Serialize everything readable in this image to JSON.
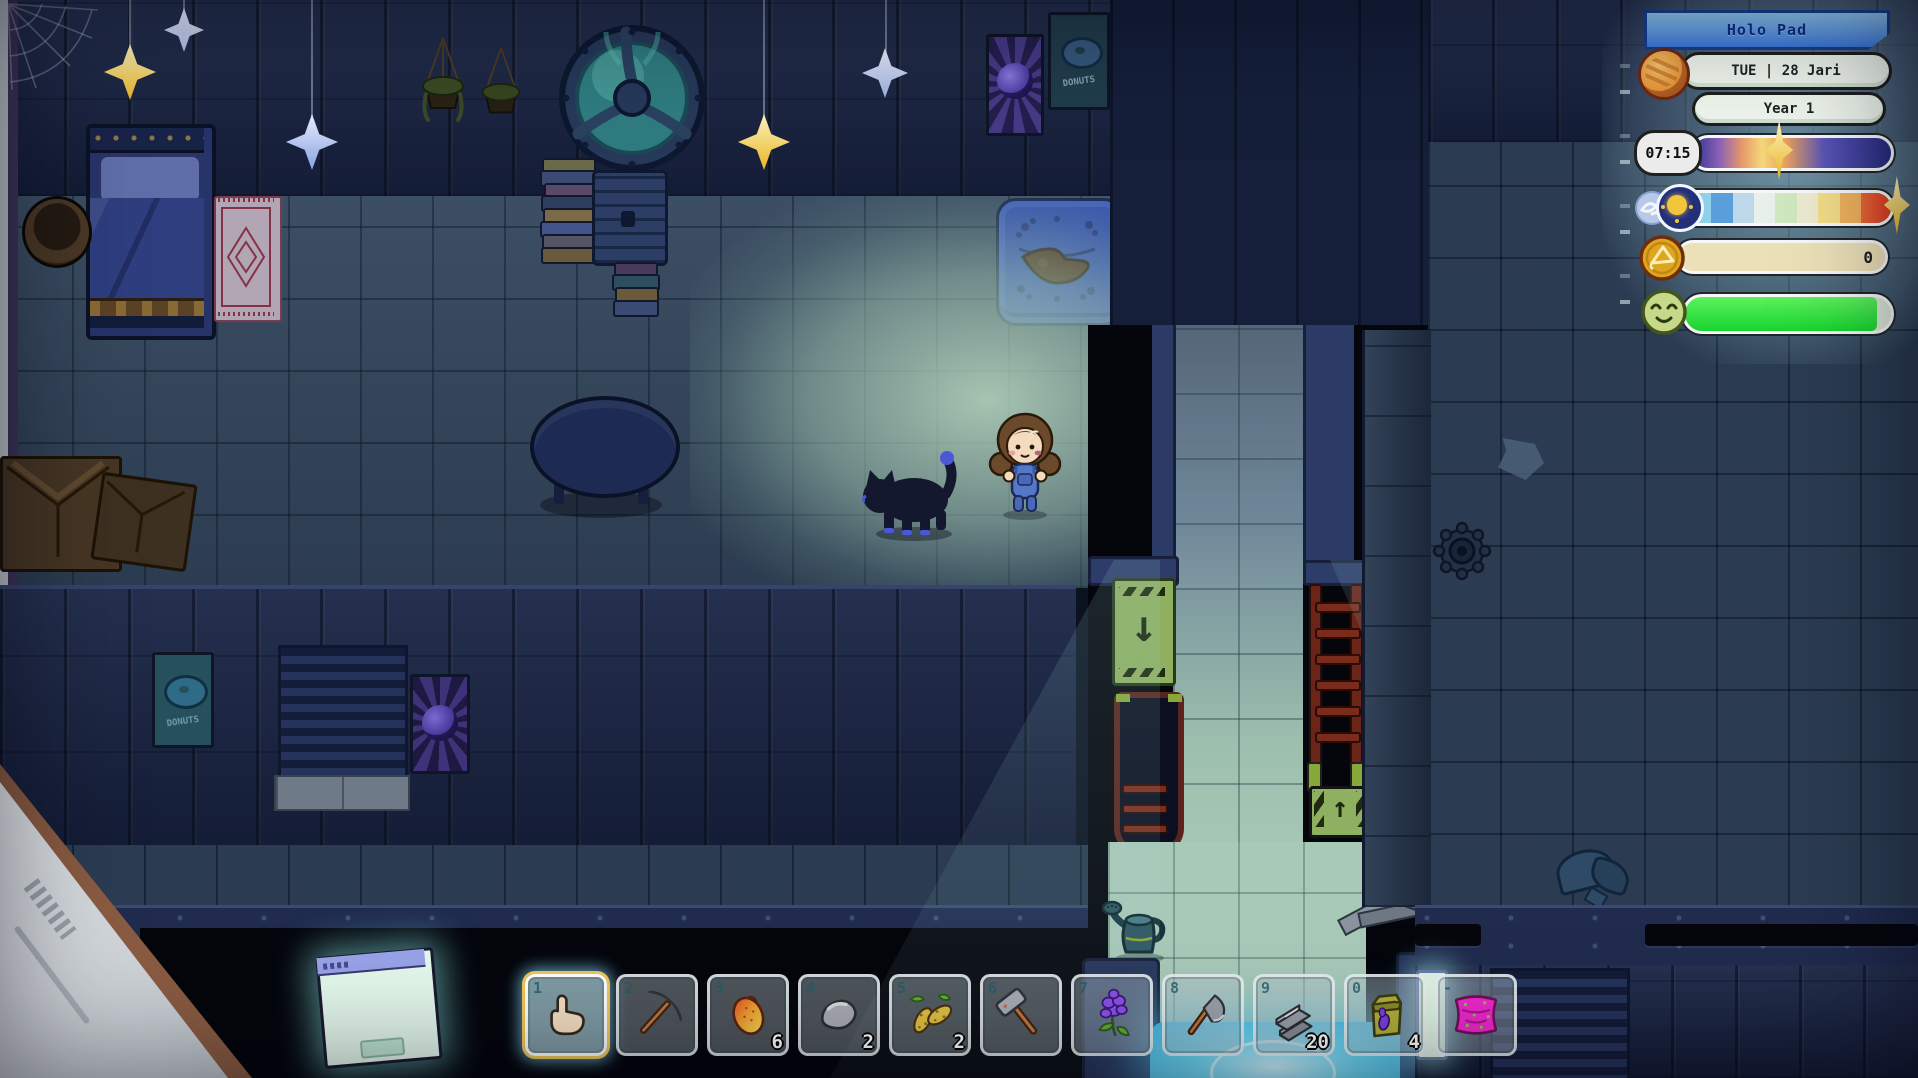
{
  "hud": {
    "title": "Holo Pad",
    "date": "TUE | 28 Jari",
    "year": "Year 1",
    "time": "07:15",
    "time_marker_percent": 33,
    "weather_marker_percent": 86,
    "currency": "0",
    "mood_percent": 93,
    "icons": {
      "date_icon": "planet-icon",
      "weather_left_icons": [
        "wind-swirl-icon",
        "sun-icon"
      ],
      "currency_icon": "triangle-coin-icon",
      "mood_icon": "happy-face-icon"
    }
  },
  "hotbar": {
    "selected_slot": "1",
    "slots": [
      {
        "key": "1",
        "item": "hand-cursor",
        "count": ""
      },
      {
        "key": "2",
        "item": "pickaxe",
        "count": ""
      },
      {
        "key": "3",
        "item": "mango",
        "count": "6"
      },
      {
        "key": "4",
        "item": "stone",
        "count": "2"
      },
      {
        "key": "5",
        "item": "grub-larva",
        "count": "2"
      },
      {
        "key": "6",
        "item": "mallet",
        "count": ""
      },
      {
        "key": "7",
        "item": "lavender",
        "count": ""
      },
      {
        "key": "8",
        "item": "axe",
        "count": ""
      },
      {
        "key": "9",
        "item": "metal-sheet",
        "count": "20"
      },
      {
        "key": "0",
        "item": "seed-bag",
        "count": "4"
      },
      {
        "key": "-",
        "item": "pink-pillow",
        "count": ""
      }
    ]
  },
  "world": {
    "poster_text": "DONUTS",
    "signs": {
      "down_arrow": "↓",
      "up_arrow": "↑"
    }
  },
  "colors": {
    "hud_glow": "#afe4f0",
    "banner_blue": "#3c79dc",
    "mood_green": "#2ce23c",
    "coin_gold": "#e0a51f",
    "corridor_light": "#a9c9b8",
    "pad_cyan": "#5ad8f0",
    "wall_navy": "#1c2848"
  }
}
